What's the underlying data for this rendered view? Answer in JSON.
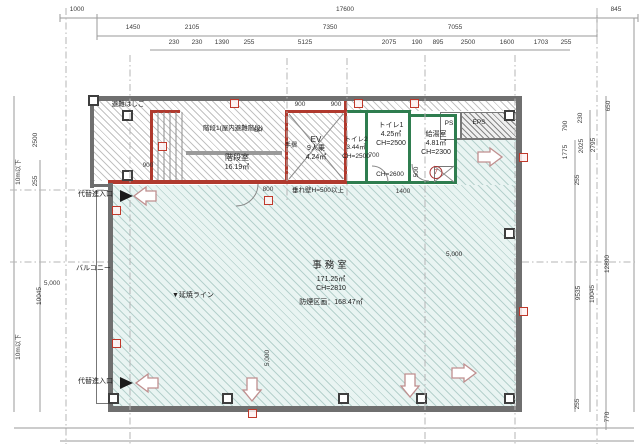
{
  "title": "平面図",
  "colors": {
    "outer_wall": "#6f6f6f",
    "thin_wall": "#777777",
    "red_wall": "#b03a2e",
    "green_wall": "#2f7d4f",
    "handrail": "#9a9a9a",
    "office_fill": "#e9f4f2",
    "arrow_stroke": "#c08f8f",
    "tag_red": "#c0392b"
  },
  "rooms": {
    "stair": {
      "ladder": "避難はしご",
      "note": "階段1(屋内避難階段)",
      "name": "階段室",
      "area": "16.19㎡",
      "up": "UP",
      "handrail": "手摺"
    },
    "elevator": {
      "name": "EV",
      "capacity": "9人乗",
      "area": "4.24㎡"
    },
    "toilet2": {
      "name": "トイレ2",
      "area": "3.44㎡",
      "ch": "CH=2500"
    },
    "toilet1": {
      "name": "トイレ1",
      "area": "4.25㎡",
      "ch": "CH=2500"
    },
    "corridor": {
      "ch": "CH=2600"
    },
    "kitchenette": {
      "name": "給湯室",
      "area": "4.81㎡",
      "ch": "CH=2300",
      "number": "7"
    },
    "shafts": {
      "ps": "PS",
      "eps": "EPS"
    },
    "office": {
      "name": "事務室",
      "area": "171.25㎡",
      "ch": "CH=2810",
      "smoke_zone": "防煙区画：168.47㎡"
    },
    "balcony": {
      "name": "バルコニー"
    },
    "annotations": {
      "entry": "代替進入口",
      "entry2": "代替進入口",
      "fire_spread_line": "▼延焼ライン",
      "hanging_wall": "垂れ壁H=500以上"
    }
  },
  "dimensions": {
    "labels": [
      {
        "t": "1000",
        "x": 77,
        "y": 10
      },
      {
        "t": "17600",
        "x": 345,
        "y": 10
      },
      {
        "t": "845",
        "x": 616,
        "y": 10
      },
      {
        "t": "1450",
        "x": 133,
        "y": 28
      },
      {
        "t": "2105",
        "x": 192,
        "y": 28
      },
      {
        "t": "7350",
        "x": 330,
        "y": 28
      },
      {
        "t": "7055",
        "x": 455,
        "y": 28
      },
      {
        "t": "230",
        "x": 174,
        "y": 43
      },
      {
        "t": "230",
        "x": 197,
        "y": 43
      },
      {
        "t": "1390",
        "x": 222,
        "y": 43
      },
      {
        "t": "255",
        "x": 249,
        "y": 43
      },
      {
        "t": "5125",
        "x": 305,
        "y": 43
      },
      {
        "t": "2075",
        "x": 389,
        "y": 43
      },
      {
        "t": "190",
        "x": 417,
        "y": 43
      },
      {
        "t": "895",
        "x": 438,
        "y": 43
      },
      {
        "t": "2500",
        "x": 468,
        "y": 43
      },
      {
        "t": "1600",
        "x": 507,
        "y": 43
      },
      {
        "t": "1703",
        "x": 541,
        "y": 43
      },
      {
        "t": "255",
        "x": 566,
        "y": 43
      },
      {
        "t": "2500",
        "x": 36,
        "y": 140,
        "v": 1
      },
      {
        "t": "255",
        "x": 36,
        "y": 181,
        "v": 1
      },
      {
        "t": "10m以下",
        "x": 19,
        "y": 172,
        "v": 1
      },
      {
        "t": "10045",
        "x": 40,
        "y": 296,
        "v": 1
      },
      {
        "t": "10m以下",
        "x": 19,
        "y": 347,
        "v": 1
      },
      {
        "t": "5,000",
        "x": 52,
        "y": 284
      },
      {
        "t": "650",
        "x": 609,
        "y": 106,
        "v": 1
      },
      {
        "t": "230",
        "x": 581,
        "y": 118,
        "v": 1
      },
      {
        "t": "790",
        "x": 566,
        "y": 126,
        "v": 1
      },
      {
        "t": "1775",
        "x": 566,
        "y": 152,
        "v": 1
      },
      {
        "t": "2025",
        "x": 582,
        "y": 146,
        "v": 1
      },
      {
        "t": "2795",
        "x": 594,
        "y": 145,
        "v": 1
      },
      {
        "t": "255",
        "x": 578,
        "y": 180,
        "v": 1
      },
      {
        "t": "9535",
        "x": 579,
        "y": 293,
        "v": 1
      },
      {
        "t": "10045",
        "x": 593,
        "y": 294,
        "v": 1
      },
      {
        "t": "12800",
        "x": 608,
        "y": 264,
        "v": 1
      },
      {
        "t": "255",
        "x": 578,
        "y": 404,
        "v": 1
      },
      {
        "t": "770",
        "x": 608,
        "y": 417,
        "v": 1
      },
      {
        "t": "900",
        "x": 148,
        "y": 166
      },
      {
        "t": "900",
        "x": 300,
        "y": 105
      },
      {
        "t": "900",
        "x": 336,
        "y": 105
      },
      {
        "t": "800",
        "x": 268,
        "y": 190
      },
      {
        "t": "700",
        "x": 374,
        "y": 156
      },
      {
        "t": "1400",
        "x": 403,
        "y": 192
      },
      {
        "t": "500",
        "x": 417,
        "y": 172,
        "v": 1
      },
      {
        "t": "5,000",
        "x": 268,
        "y": 358,
        "v": 1
      }
    ]
  },
  "geometry": {
    "hatches": [
      [
        94,
        101,
        191,
        80,
        "gray"
      ],
      [
        288,
        113,
        56,
        67,
        "gray"
      ],
      [
        347,
        101,
        169,
        10,
        "gray"
      ],
      [
        460,
        112,
        56,
        26,
        "dark"
      ],
      [
        113,
        185,
        403,
        221,
        "blue"
      ],
      [
        457,
        140,
        59,
        45,
        "blue"
      ]
    ],
    "walls": [
      [
        90,
        96,
        432,
        5,
        "o"
      ],
      [
        516,
        96,
        6,
        316,
        "o"
      ],
      [
        108,
        406,
        414,
        6,
        "o"
      ],
      [
        108,
        183,
        5,
        229,
        "o"
      ],
      [
        90,
        96,
        4,
        92,
        "o"
      ],
      [
        90,
        184,
        20,
        3,
        "o"
      ],
      [
        457,
        138,
        59,
        2,
        "t"
      ],
      [
        150,
        110,
        3,
        74,
        "r"
      ],
      [
        150,
        180,
        197,
        4,
        "r"
      ],
      [
        285,
        110,
        62,
        3,
        "r"
      ],
      [
        285,
        110,
        3,
        72,
        "r"
      ],
      [
        344,
        96,
        3,
        88,
        "r"
      ],
      [
        150,
        110,
        30,
        3,
        "r"
      ],
      [
        108,
        180,
        45,
        4,
        "r"
      ],
      [
        365,
        110,
        3,
        74,
        "g"
      ],
      [
        347,
        181,
        110,
        3,
        "g"
      ],
      [
        408,
        112,
        3,
        72,
        "g"
      ],
      [
        408,
        114,
        49,
        3,
        "g"
      ],
      [
        454,
        114,
        3,
        70,
        "g"
      ],
      [
        347,
        110,
        64,
        3,
        "g"
      ],
      [
        186,
        151,
        96,
        4,
        "h"
      ]
    ],
    "boxes": [
      [
        434,
        166,
        20,
        16
      ],
      [
        440,
        112,
        20,
        26
      ],
      [
        460,
        112,
        56,
        26
      ],
      [
        96,
        190,
        13,
        212
      ]
    ],
    "lines": [
      [
        60,
        18,
        638,
        18,
        0
      ],
      [
        97,
        36,
        597,
        36,
        0
      ],
      [
        150,
        50,
        570,
        50,
        0
      ],
      [
        60,
        14,
        60,
        22,
        0
      ],
      [
        97,
        14,
        97,
        40,
        0
      ],
      [
        597,
        14,
        597,
        40,
        0
      ],
      [
        638,
        14,
        638,
        22,
        0
      ],
      [
        14,
        96,
        14,
        412,
        0
      ],
      [
        40,
        160,
        40,
        412,
        0
      ],
      [
        575,
        140,
        575,
        412,
        0
      ],
      [
        590,
        110,
        590,
        412,
        0
      ],
      [
        606,
        96,
        606,
        430,
        0
      ],
      [
        634,
        18,
        634,
        412,
        0
      ],
      [
        14,
        428,
        634,
        428,
        0
      ],
      [
        60,
        441,
        634,
        441,
        0
      ],
      [
        66,
        8,
        66,
        444,
        1
      ],
      [
        130,
        55,
        130,
        444,
        1
      ],
      [
        287,
        58,
        287,
        200,
        1
      ],
      [
        347,
        58,
        347,
        200,
        1
      ],
      [
        425,
        55,
        425,
        444,
        1
      ],
      [
        515,
        55,
        515,
        444,
        1
      ],
      [
        597,
        8,
        597,
        444,
        1
      ],
      [
        10,
        262,
        108,
        262,
        1
      ],
      [
        522,
        262,
        636,
        262,
        1
      ],
      [
        10,
        190,
        106,
        190,
        1
      ],
      [
        158,
        112,
        158,
        180,
        2
      ],
      [
        164,
        112,
        164,
        180,
        2
      ],
      [
        170,
        112,
        170,
        180,
        2
      ],
      [
        176,
        112,
        176,
        180,
        2
      ],
      [
        182,
        112,
        182,
        180,
        2
      ],
      [
        289,
        114,
        343,
        179,
        2
      ],
      [
        343,
        114,
        289,
        179,
        2
      ],
      [
        434,
        166,
        454,
        182,
        2
      ],
      [
        454,
        166,
        434,
        182,
        2
      ]
    ],
    "arcs": [
      "M258,184 A22,22 0 0 1 236,206",
      "M388,182 A16,16 0 0 0 372,166",
      "M412,164 A17,17 0 0 0 429,181"
    ],
    "arrows": [
      "156,191 146,191 146,187 134,196 146,205 146,201 156,201",
      "158,378 148,378 148,374 136,383 148,392 148,388 158,388",
      "478,152 490,152 490,148 502,157 490,166 490,162 478,162",
      "452,368 464,368 464,364 476,373 464,382 464,378 452,378",
      "247,378 257,378 257,390 261,390 252,401 243,390 247,390",
      "405,374 415,374 415,386 419,386 410,397 401,386 405,386"
    ],
    "triangles": [
      "120,190 133,196 120,202",
      "120,377 133,383 120,389"
    ],
    "columns": [
      [
        88,
        95
      ],
      [
        122,
        110
      ],
      [
        122,
        170
      ],
      [
        108,
        393
      ],
      [
        222,
        393
      ],
      [
        338,
        393
      ],
      [
        416,
        393
      ],
      [
        504,
        393
      ],
      [
        504,
        228
      ],
      [
        504,
        110
      ]
    ],
    "tags": [
      [
        158,
        142
      ],
      [
        112,
        206
      ],
      [
        112,
        339
      ],
      [
        248,
        409
      ],
      [
        264,
        196
      ],
      [
        519,
        153
      ],
      [
        519,
        307
      ],
      [
        230,
        99
      ],
      [
        354,
        99
      ],
      [
        410,
        99
      ]
    ]
  }
}
